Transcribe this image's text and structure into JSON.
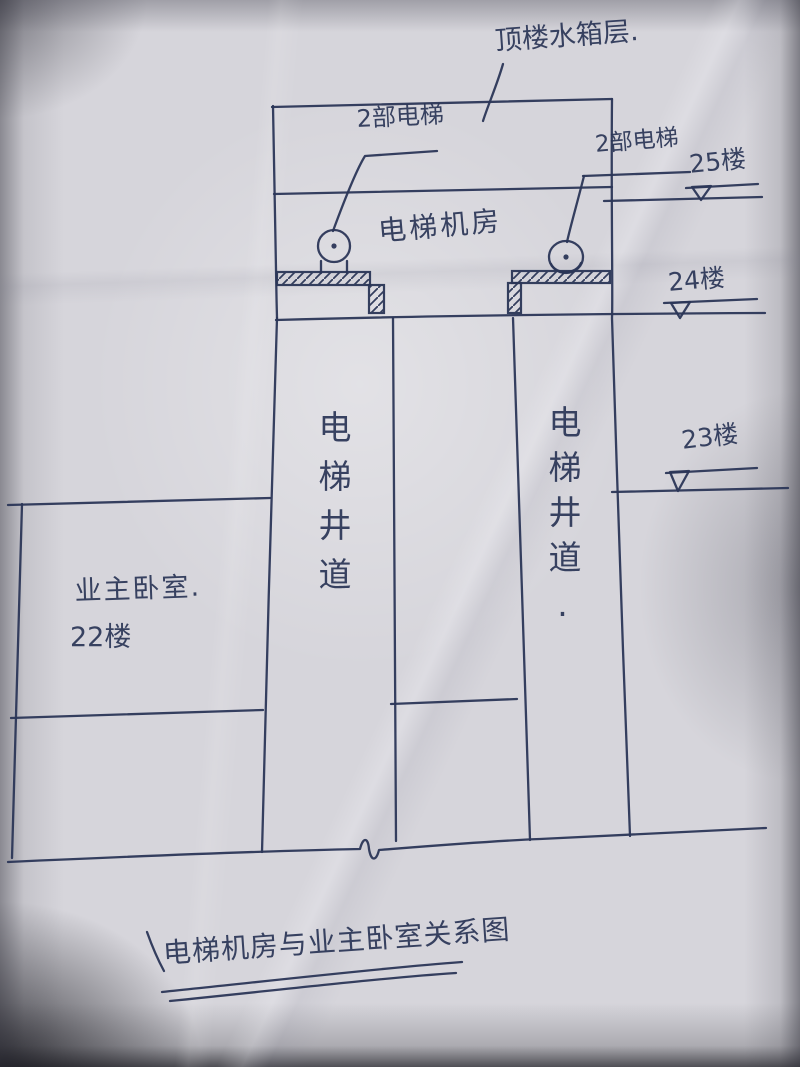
{
  "colors": {
    "ink": "#2b3657",
    "paper": "#d6d5db"
  },
  "labels": {
    "top_note": "顶楼水箱层.",
    "elevators_left": "2部电梯",
    "elevators_right": "2部电梯",
    "machine_room": "电梯机房",
    "floor_25": "25楼",
    "floor_24": "24楼",
    "floor_23": "23楼",
    "shaft_left": "电梯井道",
    "shaft_right": "电梯井道.",
    "bedroom_owner": "业主卧室.",
    "bedroom_floor": "22楼",
    "caption": "电梯机房与业主卧室关系图"
  }
}
